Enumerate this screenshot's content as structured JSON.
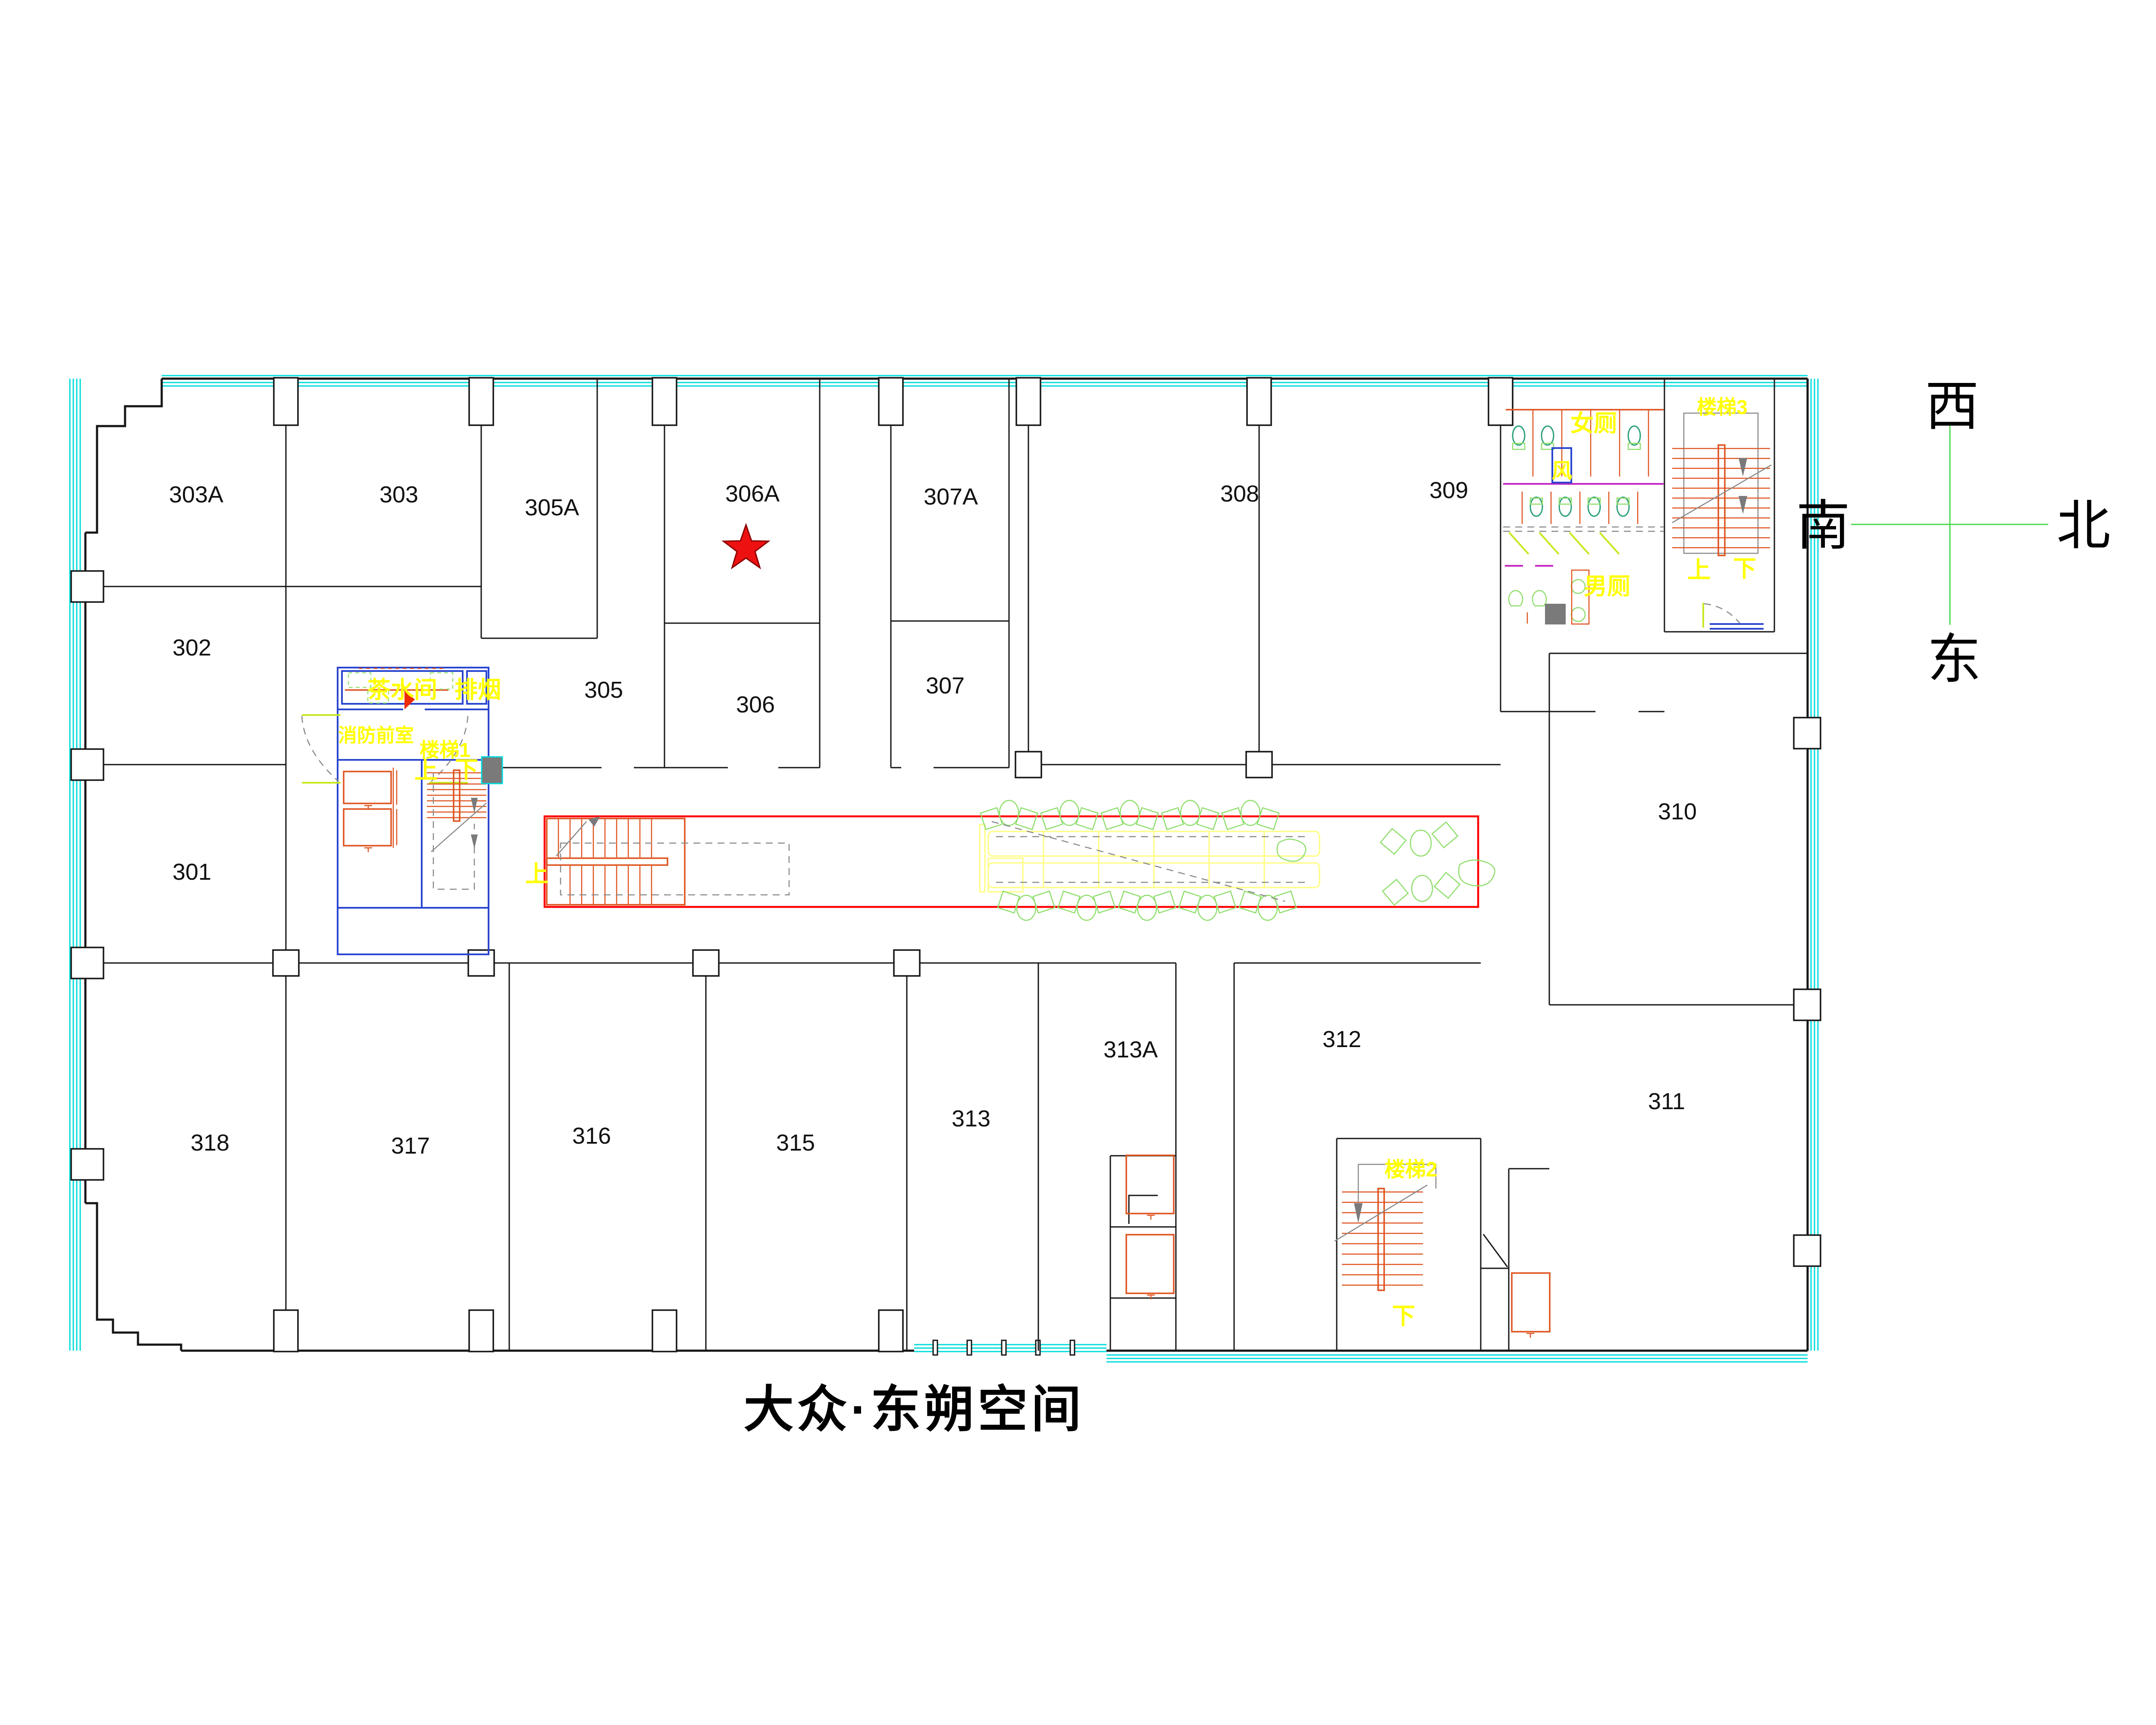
{
  "title": "大众·东朔空间",
  "compass": {
    "top": "西",
    "left": "南",
    "right": "北",
    "bottom": "东"
  },
  "rooms": [
    {
      "label": "303A"
    },
    {
      "label": "303"
    },
    {
      "label": "305A"
    },
    {
      "label": "306A"
    },
    {
      "label": "307A"
    },
    {
      "label": "308"
    },
    {
      "label": "309"
    },
    {
      "label": "302"
    },
    {
      "label": "301"
    },
    {
      "label": "305"
    },
    {
      "label": "306"
    },
    {
      "label": "307"
    },
    {
      "label": "310"
    },
    {
      "label": "311"
    },
    {
      "label": "312"
    },
    {
      "label": "313A"
    },
    {
      "label": "313"
    },
    {
      "label": "315"
    },
    {
      "label": "316"
    },
    {
      "label": "317"
    },
    {
      "label": "318"
    }
  ],
  "annotations": {
    "tea_room": "茶水间",
    "smoke_exhaust": "排烟",
    "fire_lobby": "消防前室",
    "stair1": "楼梯1",
    "stair2": "楼梯2",
    "stair3": "楼梯3",
    "up": "上",
    "down": "下",
    "womens_toilet": "女厕",
    "mens_toilet": "男厕",
    "vent": "风"
  },
  "marker": {
    "room": "306A",
    "shape": "five-pointed-star"
  },
  "colors": {
    "glass_cyan": "#00dcdc",
    "wall_black": "#161616",
    "corridor_red": "#ff0000",
    "stair_orange": "#df5420",
    "core_blue": "#2b46cf",
    "label_yellow": "#ffff00",
    "furniture_yellow": "#ffff80",
    "plant_green": "#8ede6a",
    "fixture_teal": "#2aa07a",
    "counter_purple": "#c428c4",
    "door_gray": "#8a8a8a",
    "compass_green": "#4cd94c",
    "star_red": "#ee1111"
  }
}
